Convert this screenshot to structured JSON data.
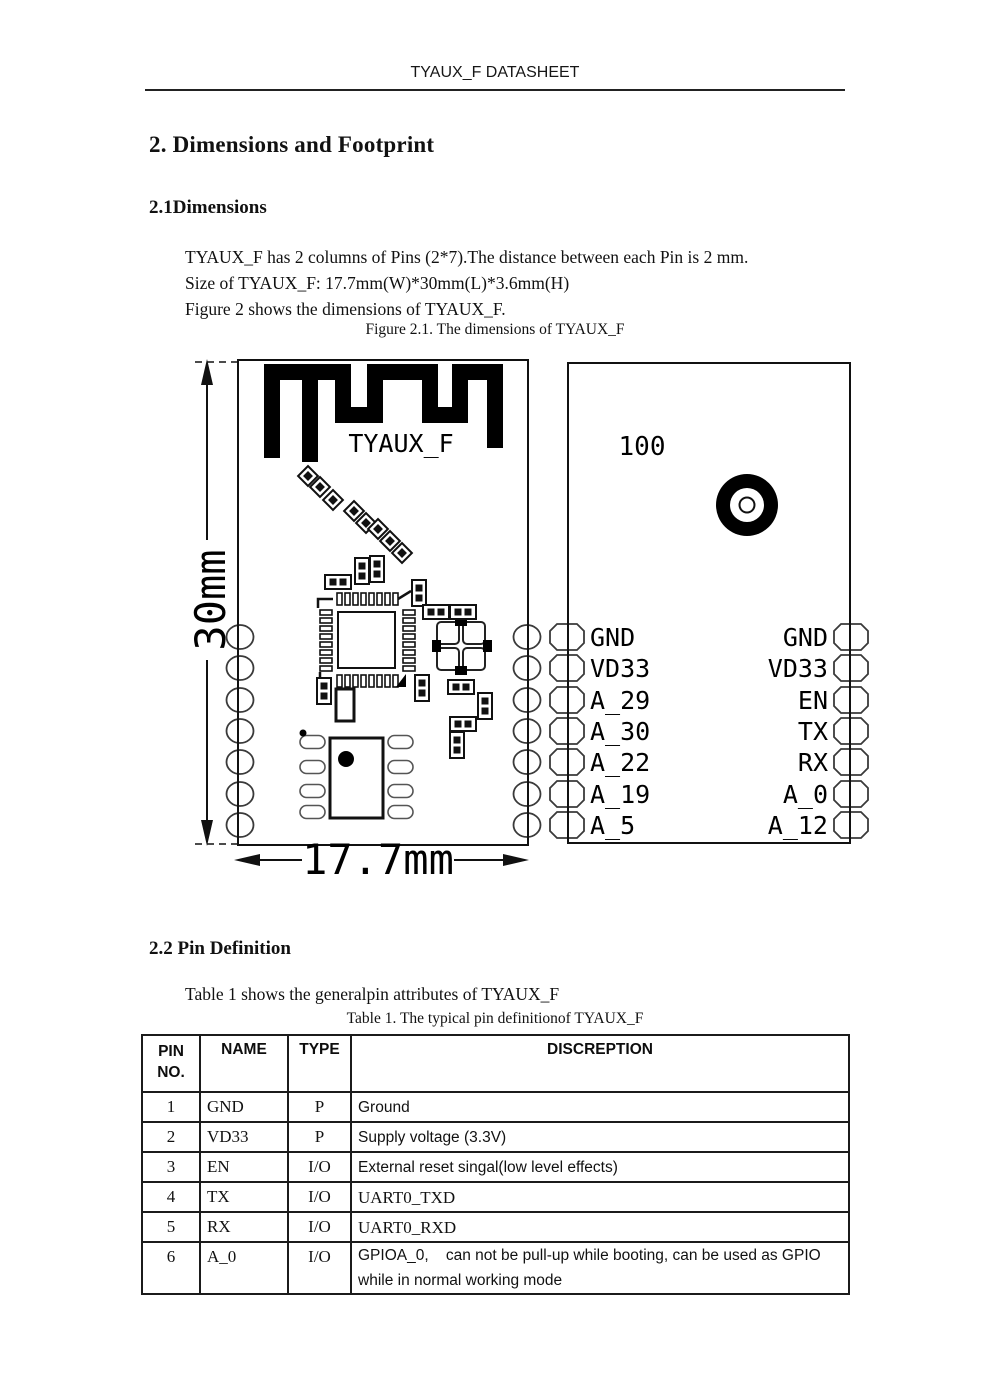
{
  "header": {
    "title": "TYAUX_F DATASHEET"
  },
  "section": {
    "title": "2. Dimensions and Footprint",
    "sub1": "2.1Dimensions",
    "body_lines": [
      "TYAUX_F has 2 columns of Pins (2*7).The distance between each Pin is 2 mm.",
      "Size of TYAUX_F: 17.7mm(W)*30mm(L)*3.6mm(H)",
      "Figure 2 shows the dimensions of TYAUX_F."
    ],
    "figure_caption": "Figure 2.1. The dimensions of TYAUX_F",
    "sub2": "2.2 Pin Definition",
    "table_intro": "Table 1 shows the generalpin attributes of TYAUX_F",
    "table_caption": "Table 1. The typical pin definitionof TYAUX_F"
  },
  "figure": {
    "top_view": {
      "module_label": "TYAUX_F",
      "height_dim": "30mm",
      "width_dim": "17.7mm"
    },
    "bottom_view": {
      "marking": "100",
      "left_pins": [
        "GND",
        "VD33",
        "A_29",
        "A_30",
        "A_22",
        "A_19",
        "A_5"
      ],
      "right_pins": [
        "GND",
        "VD33",
        "EN",
        "TX",
        "RX",
        "A_0",
        "A_12"
      ]
    }
  },
  "pin_table": {
    "headers": {
      "pin_line1": "PIN",
      "pin_line2": "NO.",
      "name": "NAME",
      "type": "TYPE",
      "description": "DISCREPTION"
    },
    "rows": [
      {
        "no": "1",
        "name": "GND",
        "type": "P",
        "desc": "Ground"
      },
      {
        "no": "2",
        "name": "VD33",
        "type": "P",
        "desc": "Supply voltage (3.3V)"
      },
      {
        "no": "3",
        "name": "EN",
        "type": "I/O",
        "desc": "External reset singal(low level effects)"
      },
      {
        "no": "4",
        "name": "TX",
        "type": "I/O",
        "desc": "UART0_TXD"
      },
      {
        "no": "5",
        "name": "RX",
        "type": "I/O",
        "desc": "UART0_RXD"
      },
      {
        "no": "6",
        "name": "A_0",
        "type": "I/O",
        "desc": "GPIOA_0,    can not be pull-up while booting, can be used as GPIO while in normal working mode"
      }
    ]
  }
}
